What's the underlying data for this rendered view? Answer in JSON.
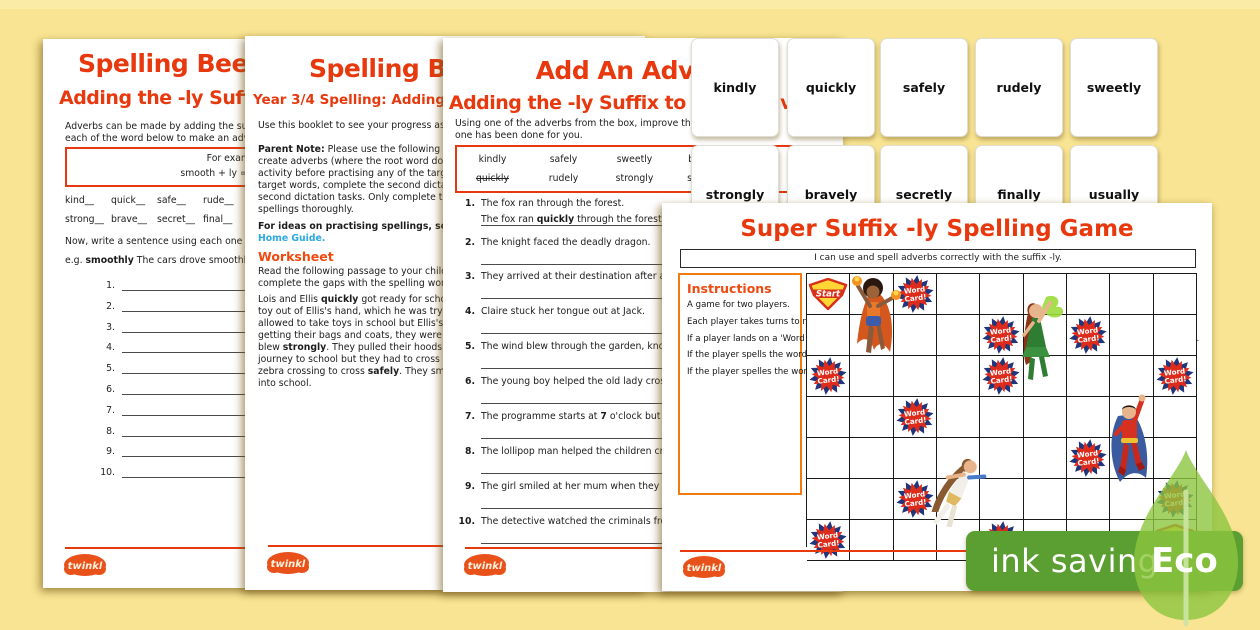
{
  "colors": {
    "accent_red": "#E8390E",
    "accent_orange": "#F07C10",
    "link_blue": "#2BA9E0",
    "badge_green": "#5B9E31",
    "leaf_green": "#8CC63F",
    "burst_red": "#DD2B1C",
    "burst_navy": "#20357A",
    "shield_yellow": "#FFD633",
    "shield_red": "#D8301A",
    "background_yellow": "#F8E492"
  },
  "page1": {
    "title_line1": "Spelling Bee's A",
    "title_line2": "Adding the -ly Suffi",
    "intro_lines": [
      "Adverbs can be made by adding the suffix -ly t",
      "each of the word below to make an adverb."
    ],
    "example_box_lines": [
      "For example:",
      "smooth + ly = smoothly"
    ],
    "word_rows": [
      [
        "kind__",
        "quick__",
        "safe__",
        "rude__"
      ],
      [
        "strong__",
        "brave__",
        "secret__",
        "final__"
      ]
    ],
    "prompt": "Now, write a sentence using each one of the ad",
    "example_sentence": "e.g. **smoothly**  The cars drove smoothly on the",
    "line_numbers": [
      "1.",
      "2.",
      "3.",
      "4.",
      "5.",
      "6.",
      "7.",
      "8.",
      "9.",
      "10."
    ]
  },
  "page2": {
    "title": "Spelling Be",
    "subtitle": "Year 3/4 Spelling: Adding th",
    "intro": "Use this booklet to see your progress as you practis",
    "parent_note_lines": [
      "**Parent Note:** Please use the following spelling dict",
      "create adverbs (where the root word doesn't change",
      "activity before practising any of the target words a",
      "target words, complete the second dictation activi",
      "second dictation tasks. Only complete the second d",
      "spellings thoroughly."
    ],
    "link_line1": "**For ideas on practising spellings, see the** [[blue]]Spe[[/blue]]",
    "link_line2": "[[blue]]Home Guide.[[/blue]]",
    "worksheet_heading": "Worksheet",
    "worksheet_lines": [
      "Read the following passage to your child and repe",
      "complete the gaps with the spelling word."
    ],
    "passage_lines": [
      "Lois and Ellis **quickly** got ready for school. When",
      "toy out of Ellis's hand, which he was trying to **s**",
      "allowed to take toys in school but Ellis's mum took",
      "getting their bags and coats, they were **finally** re",
      "blew **strongly**. They pulled their hoods up and b",
      "journey to school but they had to cross a busy ro",
      "zebra crossing to cross **safely**. They smiled **swee**",
      "into school."
    ]
  },
  "page3": {
    "title": "Add An Adverb!",
    "subtitle": "Adding the -ly Suffix to Make Adverbs",
    "intro_lines": [
      "Using one of the adverbs from the box, improve these sentences",
      "one has been done for you."
    ],
    "word_box": [
      [
        "kindly",
        "safely",
        "sweetly",
        "bravely"
      ],
      [
        "~~quickly~~",
        "rudely",
        "strongly",
        "secretly"
      ]
    ],
    "sentences": [
      {
        "num": "1.",
        "text": "The fox ran through the forest.",
        "answer": "The fox ran **quickly** through the forest."
      },
      {
        "num": "2.",
        "text": "The knight faced the deadly dragon."
      },
      {
        "num": "3.",
        "text": "They arrived at their destination after a long, tirin"
      },
      {
        "num": "4.",
        "text": "Claire stuck her tongue out at Jack."
      },
      {
        "num": "5.",
        "text": "The wind blew through the garden, knocking over"
      },
      {
        "num": "6.",
        "text": "The young boy helped the old lady cross the road."
      },
      {
        "num": "7.",
        "text": "The programme starts at **7** o'clock but tonight it is"
      },
      {
        "num": "8.",
        "text": "The lollipop man helped the children cross the roa"
      },
      {
        "num": "9.",
        "text": "The girl smiled at her mum when they were in the"
      },
      {
        "num": "10.",
        "text": "The detective watched the criminals from a hidde"
      }
    ]
  },
  "word_cards": {
    "row1": [
      "kindly",
      "quickly",
      "safely",
      "rudely",
      "sweetly"
    ],
    "row2": [
      "strongly",
      "bravely",
      "secretly",
      "finally",
      "usually"
    ]
  },
  "game": {
    "title": "Super Suffix -ly Spelling Game",
    "i_can": "I can use and spell adverbs correctly with the suffix -ly.",
    "instructions_heading": "Instructions",
    "instructions": [
      "A game for two players.",
      "Each player takes turns to roll a dice.",
      "If a player lands on a 'Word Card!' square, the other player must ask them to spell one of the words on the word cards.",
      "If the player spells the word correctly, they can roll the dice on their next turn.",
      "If the player spelles the word wrongly, they miss a turn and copy out the word three times on a whiteboard."
    ],
    "board": {
      "cols": 9,
      "rows": 7,
      "start_label": "Start",
      "finish_label": "Finish",
      "word_card_label": "Word Card!",
      "word_card_cells": [
        [
          3,
          1
        ],
        [
          5,
          2
        ],
        [
          7,
          2
        ],
        [
          1,
          3
        ],
        [
          5,
          3
        ],
        [
          9,
          3
        ],
        [
          3,
          4
        ],
        [
          7,
          5
        ],
        [
          3,
          6
        ],
        [
          9,
          6
        ],
        [
          1,
          7
        ],
        [
          5,
          7
        ]
      ]
    },
    "characters": [
      "flame superhero",
      "forest superhero",
      "caped superhero",
      "swift superhero"
    ]
  },
  "eco": {
    "banner": "ink saving",
    "label": "Eco"
  },
  "brand": {
    "logo_text": "twinkl"
  }
}
